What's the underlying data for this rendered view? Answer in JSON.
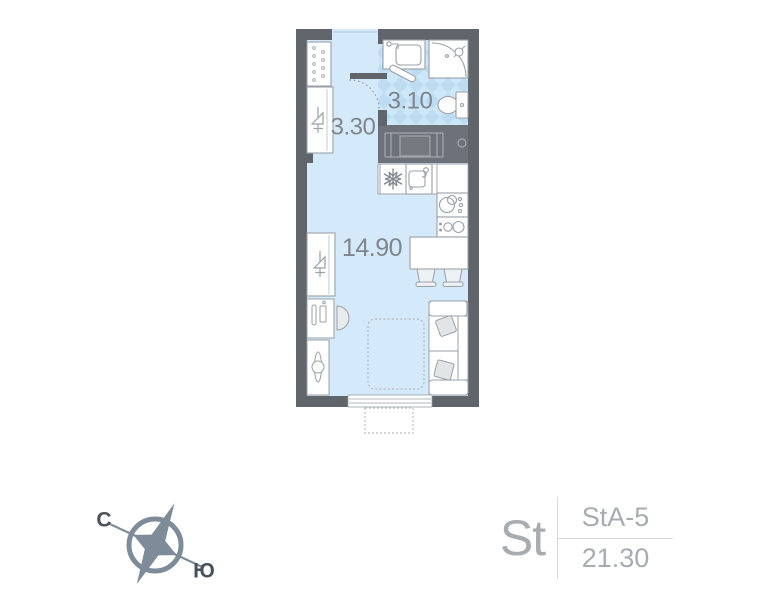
{
  "floor_plan": {
    "hallway_area": "3.30",
    "bathroom_area": "3.10",
    "living_room_area": "14.90"
  },
  "compass": {
    "north": "С",
    "south": "Ю"
  },
  "apartment_card": {
    "type_abbr": "St",
    "plan_code": "StA-5",
    "total_area": "21.30"
  },
  "colors": {
    "wall": "#60656c",
    "floor": "#d4eafb",
    "tile_dark": "#bddcf2",
    "tile_light": "#cde6f8",
    "counter": "#6d727a",
    "furniture_outline": "#9aa0a7",
    "room_label_text": "#7f858c",
    "card_text": "#a7acb1",
    "card_divider": "#d6d9dc",
    "compass_color": "#7e8b98",
    "compass_text": "#4b5158"
  },
  "icons": {
    "compass_rose": "four-point star in ring",
    "snowflake": "fridge",
    "hanger": "wardrobe",
    "shower": "corner shower cabin",
    "toilet": "toilet with tank",
    "washbasin": "bathroom sink",
    "kitchen_sink": "kitchen sink with faucet",
    "washing_machine": "washer under counter",
    "hob": "two-burner cooktop",
    "door_arc": "door swing arc"
  }
}
